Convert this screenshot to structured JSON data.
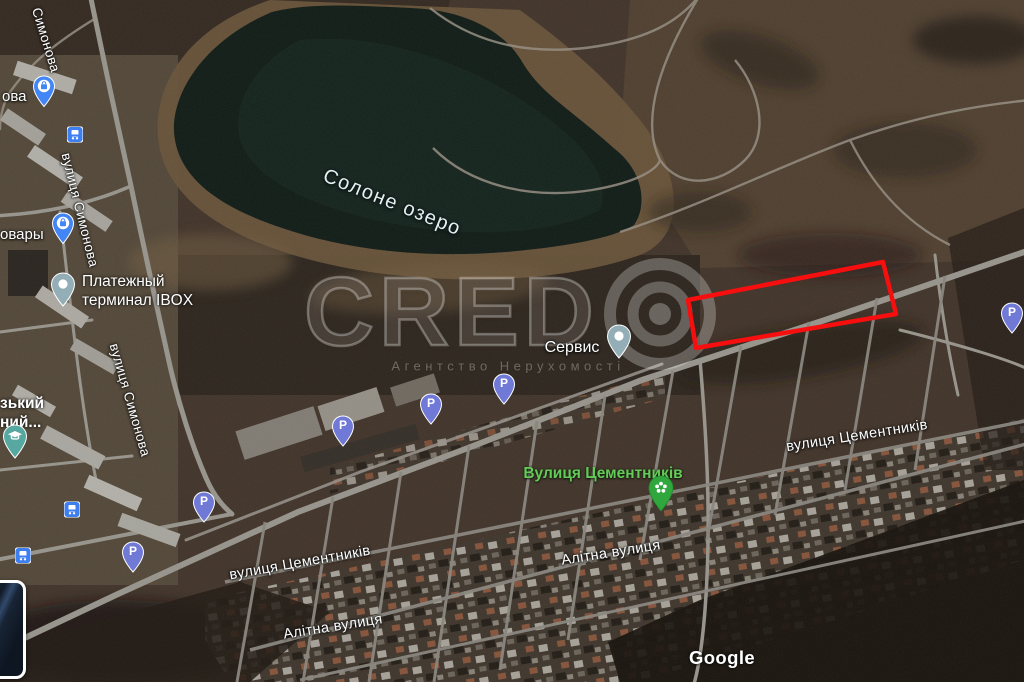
{
  "map_labels": {
    "lake": "Солоне озеро",
    "street_simonova_short": "Симонова",
    "street_simonova": "вулиця Симонова",
    "street_tsementnykiv": "вулиця Цементників",
    "place_tsementnykiv": "Вулиця Цементників",
    "street_alitna": "Алітна вулиця",
    "poi_payment_line1": "Платежный",
    "poi_payment_line2": "терминал IBOX",
    "poi_service": "Сервис",
    "clipped_shop_ova": "ова",
    "clipped_shop_ovary": "овары",
    "clipped_uni_line1": "зький",
    "clipped_uni_line2": "ний..."
  },
  "watermark": {
    "brand": "CRED",
    "subtitle": "Агентство Нерухомості"
  },
  "attribution": {
    "logo_text": "Google"
  },
  "icons": {
    "parking_letter": "P"
  },
  "colors": {
    "selection_outline": "#f70f0f",
    "parking_pin": "#7079d6",
    "park_pin": "#2fa73c",
    "transit_blue": "#3d7ef0",
    "poi_pin_slate": "#93aeb6",
    "edu_pin_teal": "#56a8a0"
  }
}
